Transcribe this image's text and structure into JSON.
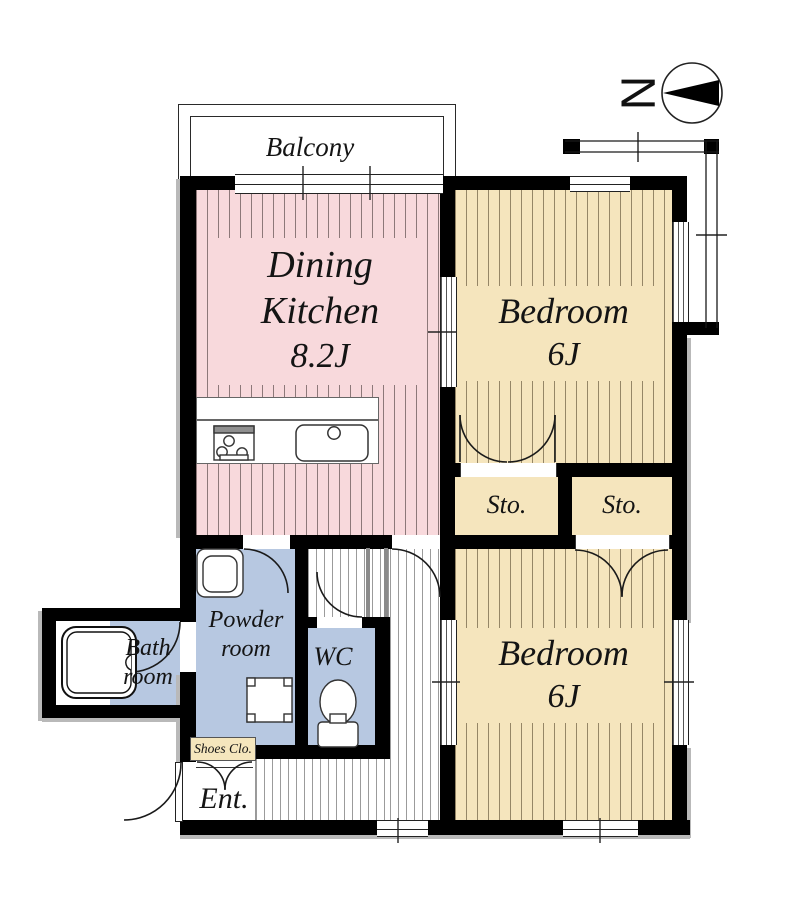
{
  "compass": {
    "north_label": "N"
  },
  "balcony": {
    "label": "Balcony"
  },
  "rooms": {
    "dining_kitchen": {
      "name": "Dining Kitchen",
      "size": "8.2J"
    },
    "bedroom_top": {
      "name": "Bedroom",
      "size": "6J"
    },
    "bedroom_bottom": {
      "name": "Bedroom",
      "size": "6J"
    },
    "storage_left": {
      "label": "Sto."
    },
    "storage_right": {
      "label": "Sto."
    },
    "bathroom": {
      "name": "Bath room"
    },
    "powder_room": {
      "name": "Powder room"
    },
    "wc": {
      "label": "WC"
    },
    "shoes_closet": {
      "label": "Shoes Clo."
    },
    "entrance": {
      "label": "Ent."
    }
  },
  "colors": {
    "wall": "#000000",
    "dining_kitchen_fill": "#f8d9dc",
    "bedroom_fill": "#f5e5bd",
    "wet_area_fill": "#b7c8e1",
    "shoes_closet_label_fill": "#f5e6bd",
    "hall_stripe": "#9b9b9b"
  }
}
